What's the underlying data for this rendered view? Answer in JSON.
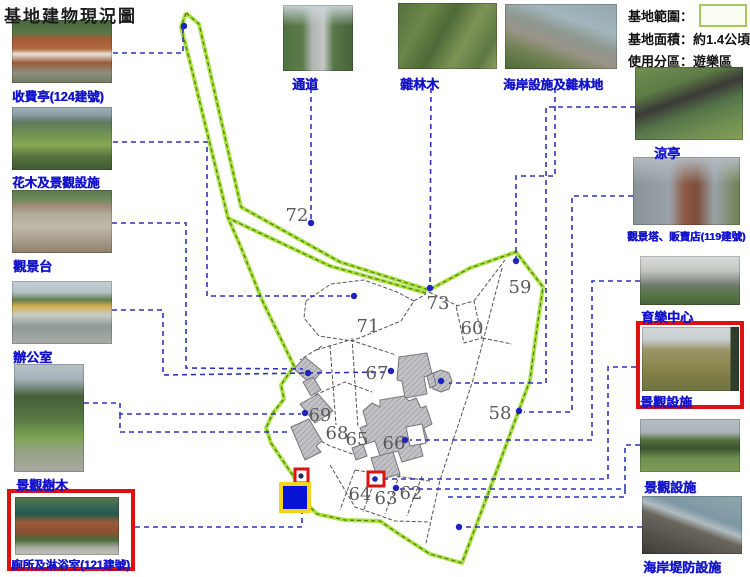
{
  "title": "基地建物現況圖",
  "legend": {
    "boundary_label": "基地範圍：",
    "area_text": "基地面積：約1.4公頃",
    "zoning_text": "使用分區：遊樂區"
  },
  "photos": {
    "left": [
      {
        "label": "收費亭(124建號)",
        "highlighted": false
      },
      {
        "label": "花木及景觀設施",
        "highlighted": false
      },
      {
        "label": "觀景台",
        "highlighted": false
      },
      {
        "label": "辦公室",
        "highlighted": false
      },
      {
        "label": "景觀樹木",
        "highlighted": false
      },
      {
        "label": "廁所及淋浴室(121建號)",
        "highlighted": true
      }
    ],
    "top": [
      {
        "label": "通道",
        "highlighted": false
      },
      {
        "label": "雜林木",
        "highlighted": false
      },
      {
        "label": "海岸設施及雜林地",
        "highlighted": false
      }
    ],
    "right": [
      {
        "label": "涼亭",
        "highlighted": false
      },
      {
        "label": "觀景塔、販賣店(119建號)",
        "highlighted": false
      },
      {
        "label": "育樂中心",
        "highlighted": false
      },
      {
        "label": "景觀設施",
        "highlighted": true
      },
      {
        "label": "景觀設施",
        "highlighted": false
      },
      {
        "label": "海岸堤防設施",
        "highlighted": false
      }
    ]
  },
  "map": {
    "parcels": [
      {
        "id": "72"
      },
      {
        "id": "73"
      },
      {
        "id": "59"
      },
      {
        "id": "71"
      },
      {
        "id": "60"
      },
      {
        "id": "67"
      },
      {
        "id": "69"
      },
      {
        "id": "68"
      },
      {
        "id": "65"
      },
      {
        "id": "66"
      },
      {
        "id": "58"
      },
      {
        "id": "64"
      },
      {
        "id": "63"
      },
      {
        "id": "62"
      }
    ],
    "colors": {
      "boundary_green": "#a9e140",
      "leader_blue": "#2c35b8",
      "marker_red": "#dd1111",
      "marker_blue_fill": "#0712d6",
      "marker_yellow_border": "#f2d51c"
    }
  }
}
